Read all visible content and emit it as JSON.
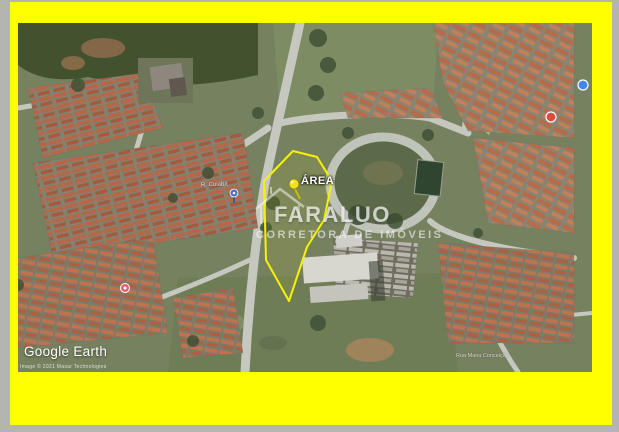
{
  "page": {
    "frame_color": "#ffff00",
    "edge_color": "#b4b4b2"
  },
  "map": {
    "annotation": {
      "area_label": "ÁREA",
      "boundary_color": "#f6f203"
    },
    "watermark": {
      "line1": "FARALUO",
      "line2": "CORRETORA DE IMÓVEIS"
    },
    "branding": {
      "logo": "Google Earth",
      "attribution": "Image © 2021 Maxar Technologies"
    },
    "street_labels": [
      {
        "text": "R. Cuiabá"
      },
      {
        "text": "Rua Maria Conceição"
      }
    ],
    "markers": [
      {
        "name": "area-pushpin",
        "color": "#f2e11c"
      },
      {
        "name": "place-pin-blue",
        "color": "#4a71c8"
      },
      {
        "name": "place-dot-pink",
        "color": "#df5f75"
      },
      {
        "name": "place-dot-blue",
        "color": "#4285f4"
      },
      {
        "name": "place-dot-red",
        "color": "#dd4b3e"
      }
    ],
    "colors": {
      "field": "#76815f",
      "road": "#c6c8bf",
      "roof_orange": "#b3684a",
      "trees": "#42522f"
    }
  }
}
